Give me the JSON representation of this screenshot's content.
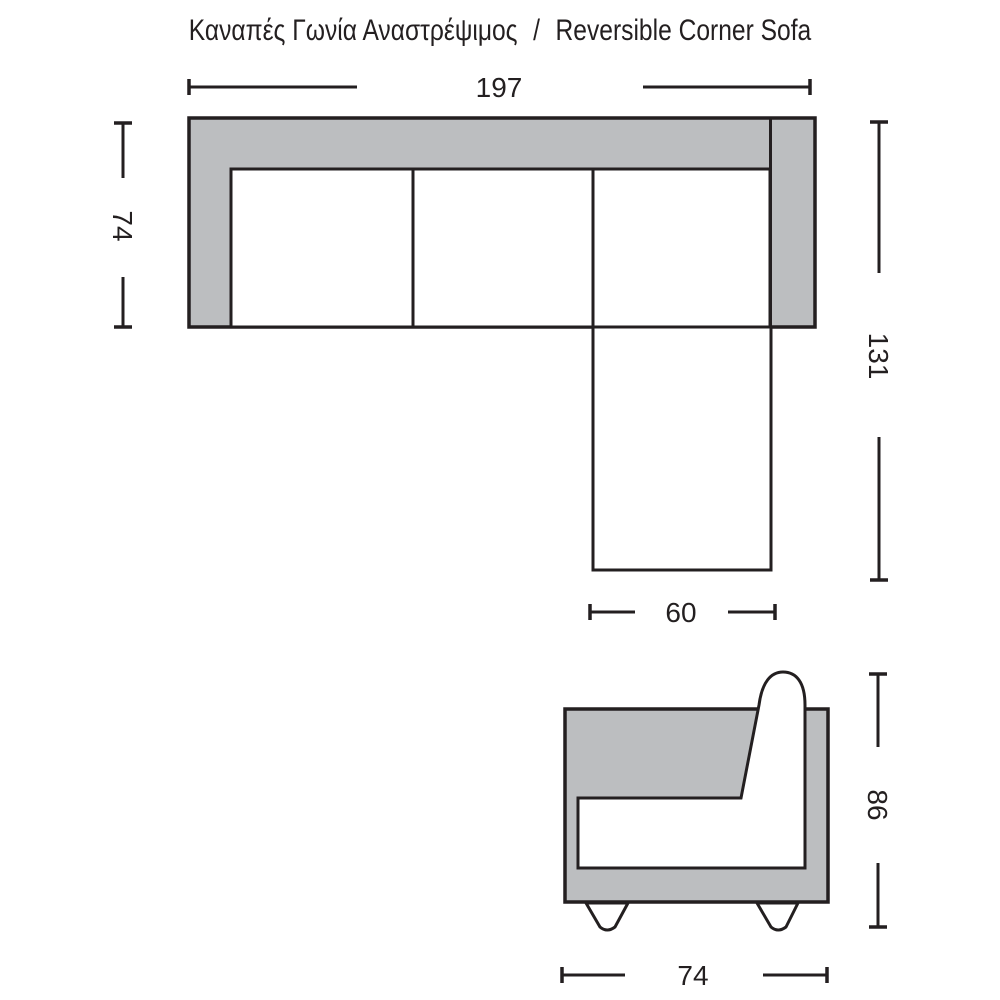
{
  "title": {
    "greek": "Καναπές Γωνία Αναστρέψιμος",
    "separator": "/",
    "english": "Reversible Corner Sofa"
  },
  "colors": {
    "line": "#231f20",
    "sofa_gray": "#bcbec0",
    "background": "#ffffff"
  },
  "top_view": {
    "view": "plan view of reversible corner sofa",
    "dimensions": {
      "total_width": "197",
      "depth": "74",
      "right_side_length": "131",
      "chaise_width": "60"
    }
  },
  "side_view": {
    "view": "side profile of sofa",
    "dimensions": {
      "height": "86",
      "depth": "74"
    }
  }
}
